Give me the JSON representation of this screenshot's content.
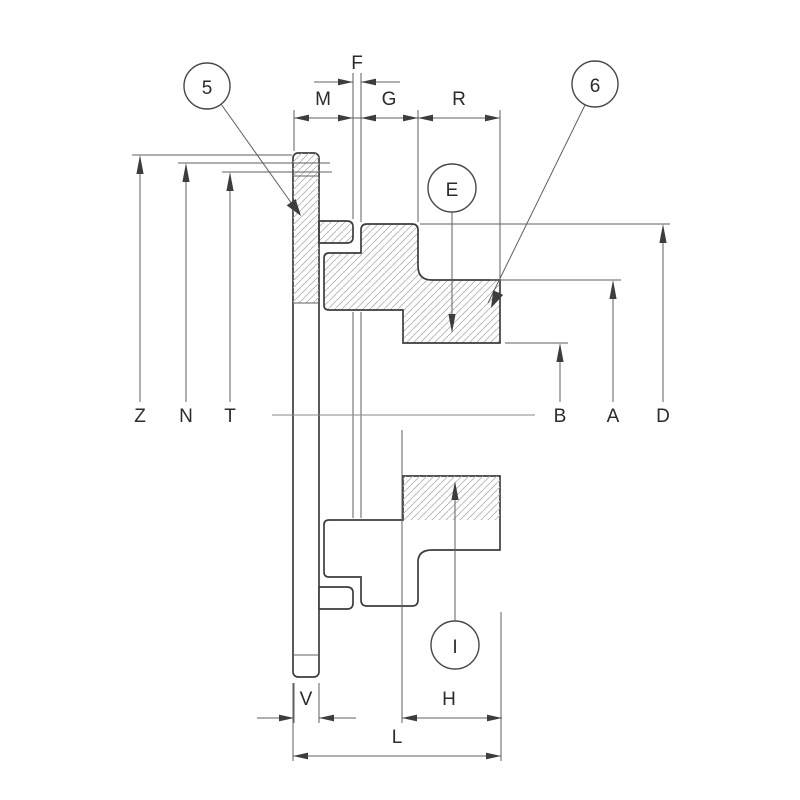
{
  "drawing_type": "section-drawing-flanged-coupling",
  "labels": {
    "f": "F",
    "m": "M",
    "g": "G",
    "r": "R",
    "z": "Z",
    "n": "N",
    "t": "T",
    "b": "B",
    "a": "A",
    "d": "D",
    "v": "V",
    "h": "H",
    "l": "L",
    "e": "E",
    "i": "I"
  },
  "balloons": {
    "b5": "5",
    "b6": "6"
  },
  "colors": {
    "bg": "#ffffff",
    "outline": "#3d3d3d",
    "thin": "#5f5f5f",
    "hatch": "#b3b3b3",
    "text": "#2b2b2b",
    "axis": "#8a8a8a"
  }
}
